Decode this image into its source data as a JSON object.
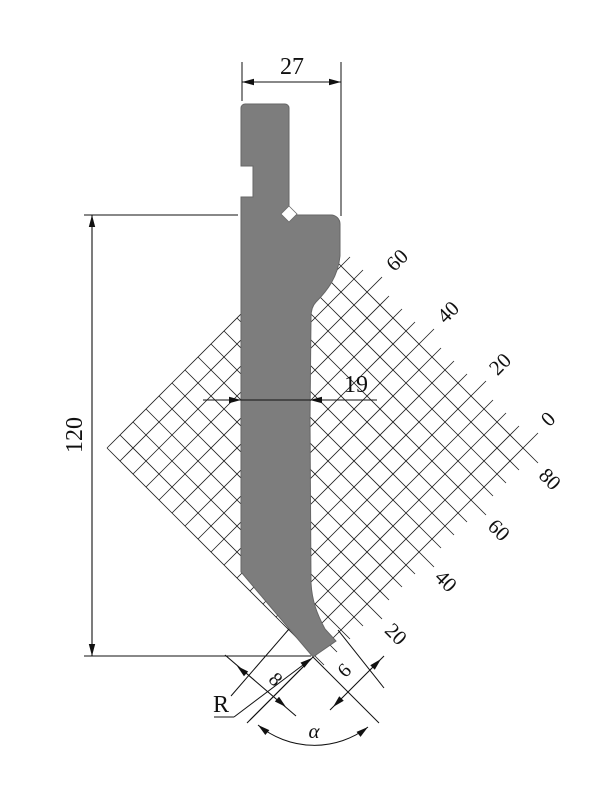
{
  "drawing": {
    "title": "press-brake-punch-technical-drawing",
    "dimensions": {
      "top_width": "27",
      "total_height": "120",
      "blade_width": "19",
      "tip_left_offset": "8",
      "tip_right_offset": "6",
      "radius_label": "R",
      "angle_label": "α"
    },
    "scale_labels": {
      "upper_edge": [
        "60",
        "40",
        "20",
        "0"
      ],
      "lower_edge": [
        "80",
        "60",
        "40",
        "20"
      ]
    },
    "colors": {
      "punch_fill": "#7d7d7d",
      "punch_edge": "#666666",
      "line": "#111111",
      "background": "#ffffff"
    }
  }
}
